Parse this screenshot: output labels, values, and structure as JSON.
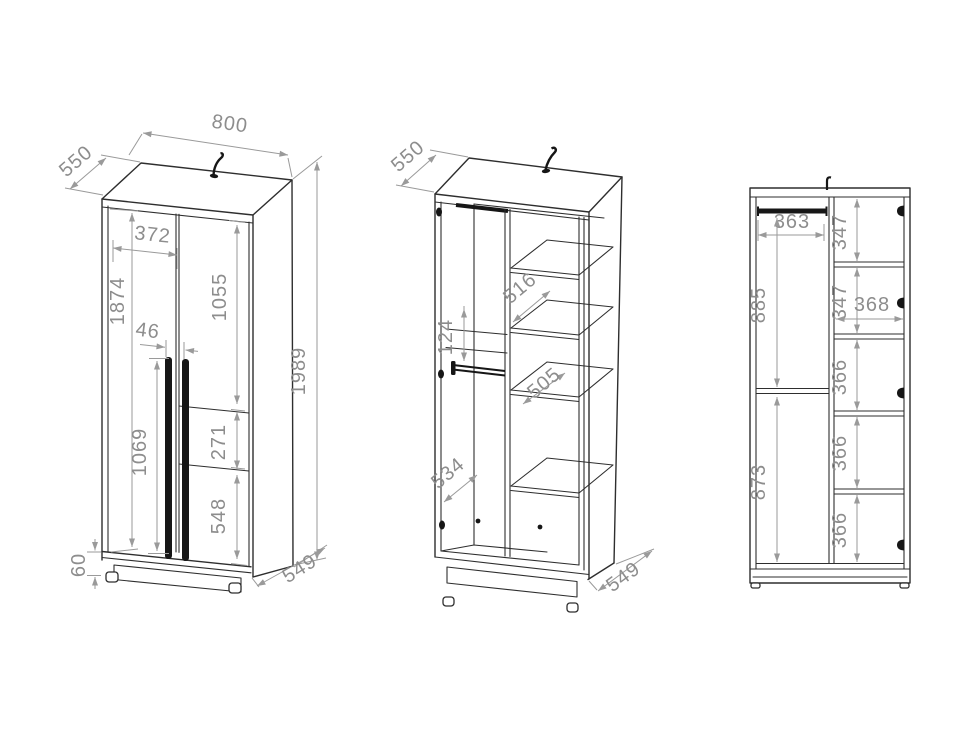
{
  "drawing": {
    "background": "#ffffff",
    "structure_line_color": "#2e2e2e",
    "hardware_color": "#161616",
    "dimension_line_color": "#9a9a9a",
    "dimension_text_color": "#8d8d8d"
  },
  "views": {
    "front_closed": {
      "dims": {
        "top_width": "800",
        "top_depth": "550",
        "left_door_width": "372",
        "door_height": "1874",
        "right_door_upper_height": "1055",
        "handle_gap": "46",
        "handle_length": "1069",
        "right_door_middle_height": "271",
        "right_door_lower_height": "548",
        "total_height": "1989",
        "plinth_height": "60",
        "bottom_depth": "549"
      }
    },
    "open_interior": {
      "dims": {
        "top_depth": "550",
        "upper_shelf_depth": "516",
        "back_gap": "124",
        "lower_shelf_depth": "505",
        "hanging_section_depth": "534",
        "bottom_depth": "549"
      }
    },
    "front_section": {
      "dims": {
        "hanging_width": "363",
        "hanging_upper_height": "885",
        "hanging_lower_height": "873",
        "shelf_cell_1": "347",
        "shelf_cell_2": "347",
        "shelf_width": "368",
        "shelf_cell_3": "366",
        "shelf_cell_4": "366",
        "shelf_cell_5": "366"
      }
    }
  }
}
